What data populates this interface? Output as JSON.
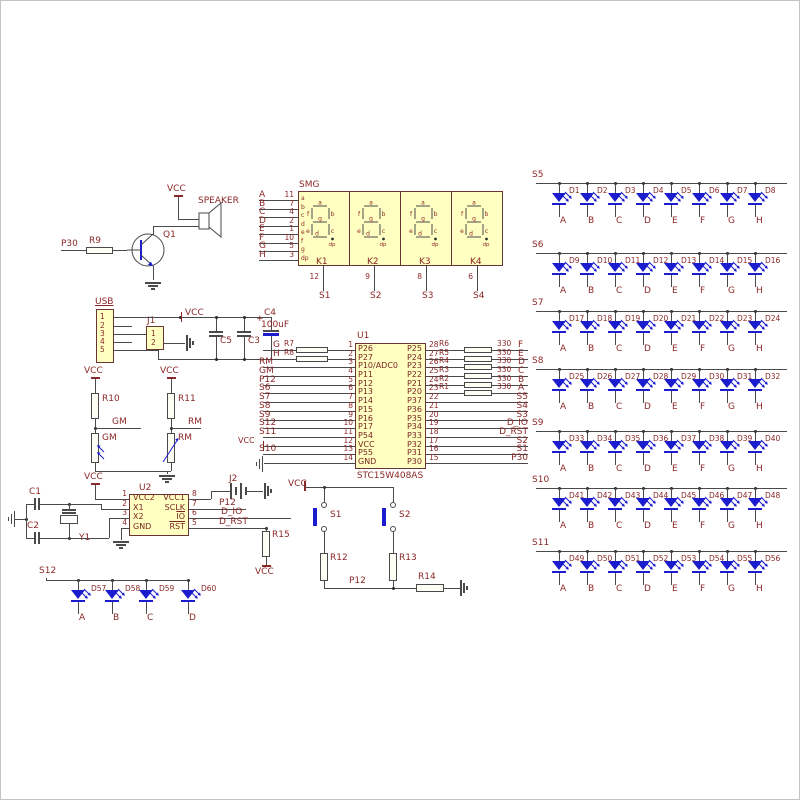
{
  "colors": {
    "wire": "#4a4a4a",
    "text": "#8b2727",
    "component_fill": "#ffffc2",
    "component_border": "#6b3434",
    "blue": "#1c1ccf",
    "background": "#ffffff"
  },
  "speaker_section": {
    "vcc": "VCC",
    "speaker": "SPEAKER",
    "transistor": "Q1",
    "net": "P30",
    "resistor": "R9"
  },
  "smg": {
    "title": "SMG",
    "inputs": [
      {
        "net": "A",
        "pin": "11",
        "seg": "a"
      },
      {
        "net": "B",
        "pin": "7",
        "seg": "b"
      },
      {
        "net": "C",
        "pin": "4",
        "seg": "c"
      },
      {
        "net": "D",
        "pin": "2",
        "seg": "d"
      },
      {
        "net": "E",
        "pin": "1",
        "seg": "e"
      },
      {
        "net": "F",
        "pin": "10",
        "seg": "f"
      },
      {
        "net": "G",
        "pin": "5",
        "seg": "g"
      },
      {
        "net": "H",
        "pin": "3",
        "seg": "dp"
      }
    ],
    "digits": [
      {
        "label": "K1",
        "pin": "12",
        "net": "S1"
      },
      {
        "label": "K2",
        "pin": "9",
        "net": "S2"
      },
      {
        "label": "K3",
        "pin": "8",
        "net": "S3"
      },
      {
        "label": "K4",
        "pin": "6",
        "net": "S4"
      }
    ]
  },
  "usb_section": {
    "title": "USB",
    "pins": [
      "1",
      "2",
      "3",
      "4",
      "5"
    ],
    "j1": "J1",
    "j1_pins": [
      "1",
      "2"
    ],
    "vcc": "VCC",
    "c5": "C5",
    "c3": "C3",
    "c4": "C4",
    "c4_value": "100uF",
    "c4_plus": "+"
  },
  "sensors": {
    "left": {
      "vcc": "VCC",
      "resistor": "R10",
      "net": "GM",
      "sensor": "GM"
    },
    "right": {
      "vcc": "VCC",
      "resistor": "R11",
      "net": "RM",
      "sensor": "RM"
    }
  },
  "u1": {
    "designator": "U1",
    "part": "STC15W408AS",
    "left_pins": [
      {
        "num": "1",
        "name": "P26",
        "net": "G",
        "res": "R7"
      },
      {
        "num": "2",
        "name": "P27",
        "net": "H",
        "res": "R8"
      },
      {
        "num": "3",
        "name": "P10/ADC0",
        "net": "RM"
      },
      {
        "num": "4",
        "name": "P11",
        "net": "GM"
      },
      {
        "num": "5",
        "name": "P12",
        "net": "P12"
      },
      {
        "num": "6",
        "name": "P13",
        "net": "S6"
      },
      {
        "num": "7",
        "name": "P14",
        "net": "S7"
      },
      {
        "num": "8",
        "name": "P15",
        "net": "S8"
      },
      {
        "num": "9",
        "name": "P16",
        "net": "S9"
      },
      {
        "num": "10",
        "name": "P17",
        "net": "S12"
      },
      {
        "num": "11",
        "name": "P54",
        "net": "S11"
      },
      {
        "num": "12",
        "name": "VCC",
        "net": "VCC"
      },
      {
        "num": "13",
        "name": "P55",
        "net": "S10"
      },
      {
        "num": "14",
        "name": "GND",
        "net": "GND"
      }
    ],
    "right_pins": [
      {
        "num": "28",
        "name": "P25",
        "res": "R6",
        "value": "330",
        "net": "F"
      },
      {
        "num": "27",
        "name": "P24",
        "res": "R5",
        "value": "330",
        "net": "E"
      },
      {
        "num": "26",
        "name": "P23",
        "res": "R4",
        "value": "330",
        "net": "D"
      },
      {
        "num": "25",
        "name": "P22",
        "res": "R3",
        "value": "330",
        "net": "C"
      },
      {
        "num": "24",
        "name": "P21",
        "res": "R2",
        "value": "330",
        "net": "B"
      },
      {
        "num": "23",
        "name": "P20",
        "res": "R1",
        "value": "330",
        "net": "A"
      },
      {
        "num": "22",
        "name": "P37",
        "net": "S5"
      },
      {
        "num": "21",
        "name": "P36",
        "net": "S4"
      },
      {
        "num": "20",
        "name": "P35",
        "net": "S3"
      },
      {
        "num": "19",
        "name": "P34",
        "net": "D_IO"
      },
      {
        "num": "18",
        "name": "P33",
        "net": "D_RST"
      },
      {
        "num": "17",
        "name": "P32",
        "net": "S2"
      },
      {
        "num": "16",
        "name": "P31",
        "net": "S1"
      },
      {
        "num": "15",
        "name": "P30",
        "net": "P30"
      }
    ]
  },
  "u2": {
    "designator": "U2",
    "vcc": "VCC",
    "left_pins": [
      {
        "num": "1",
        "name": "VCC2"
      },
      {
        "num": "2",
        "name": "X1"
      },
      {
        "num": "3",
        "name": "X2"
      },
      {
        "num": "4",
        "name": "GND"
      }
    ],
    "right_pins": [
      {
        "num": "8",
        "name": "VCC1"
      },
      {
        "num": "7",
        "name": "SCLK"
      },
      {
        "num": "6",
        "name": "IO",
        "overline": true
      },
      {
        "num": "5",
        "name": "RST",
        "overline": true
      }
    ],
    "c1": "C1",
    "c2": "C2",
    "y1": "Y1",
    "j2": "J2",
    "p12": "P12",
    "d_io": "D_IO",
    "d_rst": "D_RST",
    "r15": "R15",
    "r15_vcc": "VCC"
  },
  "buttons": {
    "vcc": "VCC",
    "s1": "S1",
    "s2": "S2",
    "r12": "R12",
    "r13": "R13",
    "r14": "R14",
    "net": "P12"
  },
  "led_rows": [
    {
      "header": "S5",
      "leds": [
        {
          "d": "D1",
          "n": "A"
        },
        {
          "d": "D2",
          "n": "B"
        },
        {
          "d": "D3",
          "n": "C"
        },
        {
          "d": "D4",
          "n": "D"
        },
        {
          "d": "D5",
          "n": "E"
        },
        {
          "d": "D6",
          "n": "F"
        },
        {
          "d": "D7",
          "n": "G"
        },
        {
          "d": "D8",
          "n": "H"
        }
      ]
    },
    {
      "header": "S6",
      "leds": [
        {
          "d": "D9",
          "n": "A"
        },
        {
          "d": "D10",
          "n": "B"
        },
        {
          "d": "D11",
          "n": "C"
        },
        {
          "d": "D12",
          "n": "D"
        },
        {
          "d": "D13",
          "n": "E"
        },
        {
          "d": "D14",
          "n": "F"
        },
        {
          "d": "D15",
          "n": "G"
        },
        {
          "d": "D16",
          "n": "H"
        }
      ]
    },
    {
      "header": "S7",
      "leds": [
        {
          "d": "D17",
          "n": "A"
        },
        {
          "d": "D18",
          "n": "B"
        },
        {
          "d": "D19",
          "n": "C"
        },
        {
          "d": "D20",
          "n": "D"
        },
        {
          "d": "D21",
          "n": "E"
        },
        {
          "d": "D22",
          "n": "F"
        },
        {
          "d": "D23",
          "n": "G"
        },
        {
          "d": "D24",
          "n": "H"
        }
      ]
    },
    {
      "header": "S8",
      "leds": [
        {
          "d": "D25",
          "n": "A"
        },
        {
          "d": "D26",
          "n": "B"
        },
        {
          "d": "D27",
          "n": "C"
        },
        {
          "d": "D28",
          "n": "D"
        },
        {
          "d": "D29",
          "n": "E"
        },
        {
          "d": "D30",
          "n": "F"
        },
        {
          "d": "D31",
          "n": "G"
        },
        {
          "d": "D32",
          "n": "H"
        }
      ]
    },
    {
      "header": "S9",
      "leds": [
        {
          "d": "D33",
          "n": "A"
        },
        {
          "d": "D34",
          "n": "B"
        },
        {
          "d": "D35",
          "n": "C"
        },
        {
          "d": "D36",
          "n": "D"
        },
        {
          "d": "D37",
          "n": "E"
        },
        {
          "d": "D38",
          "n": "F"
        },
        {
          "d": "D39",
          "n": "G"
        },
        {
          "d": "D40",
          "n": "H"
        }
      ]
    },
    {
      "header": "S10",
      "leds": [
        {
          "d": "D41",
          "n": "A"
        },
        {
          "d": "D42",
          "n": "B"
        },
        {
          "d": "D43",
          "n": "C"
        },
        {
          "d": "D44",
          "n": "D"
        },
        {
          "d": "D45",
          "n": "E"
        },
        {
          "d": "D46",
          "n": "F"
        },
        {
          "d": "D47",
          "n": "G"
        },
        {
          "d": "D48",
          "n": "H"
        }
      ]
    },
    {
      "header": "S11",
      "leds": [
        {
          "d": "D49",
          "n": "A"
        },
        {
          "d": "D50",
          "n": "B"
        },
        {
          "d": "D51",
          "n": "C"
        },
        {
          "d": "D52",
          "n": "D"
        },
        {
          "d": "D53",
          "n": "E"
        },
        {
          "d": "D54",
          "n": "F"
        },
        {
          "d": "D55",
          "n": "G"
        },
        {
          "d": "D56",
          "n": "H"
        }
      ]
    }
  ],
  "s12_row": {
    "header": "S12",
    "leds": [
      {
        "d": "D57",
        "n": "A"
      },
      {
        "d": "D58",
        "n": "B"
      },
      {
        "d": "D59",
        "n": "C"
      },
      {
        "d": "D60",
        "n": "D"
      }
    ]
  }
}
